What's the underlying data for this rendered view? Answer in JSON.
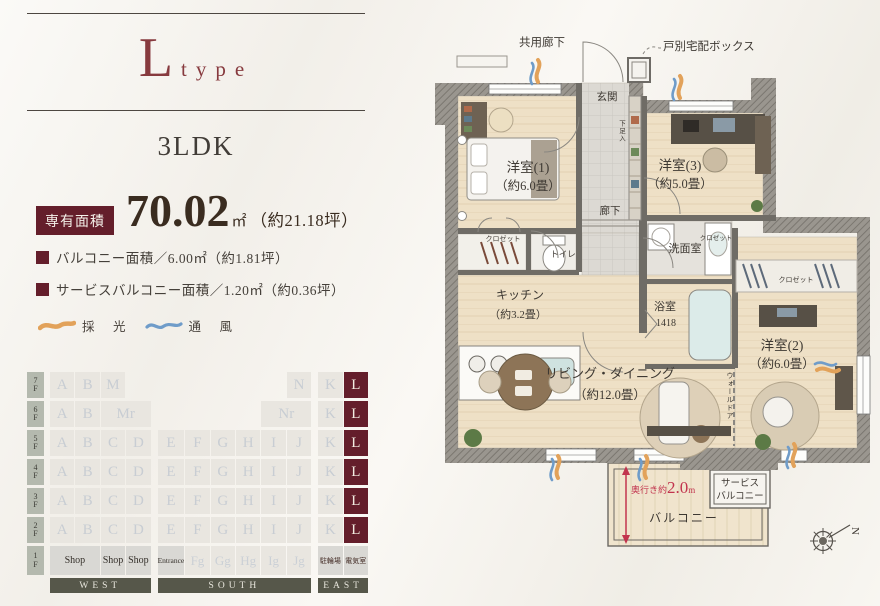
{
  "header": {
    "type_letter": "L",
    "type_word": "type",
    "plan_type": "3LDK"
  },
  "area": {
    "badge_label": "専有面積",
    "value": "70.02",
    "unit": "㎡",
    "tsubo_note": "（約21.18坪）",
    "sub_items": [
      "バルコニー面積／6.00㎡（約1.81坪）",
      "サービスバルコニー面積／1.20㎡（約0.36坪）"
    ]
  },
  "legend": {
    "daylight_label": "採　光",
    "ventilation_label": "通　風"
  },
  "colors": {
    "accent": "#641e2b",
    "plan_red": "#c2344e",
    "daylight": "#e2a25a",
    "ventilation": "#6f9cc9"
  },
  "floor_grid": {
    "highlight_unit": "L",
    "rows": [
      {
        "floor": "7F",
        "cells": [
          {
            "l": "A",
            "c": 1
          },
          {
            "l": "B",
            "c": 2
          },
          {
            "l": "M",
            "c": 3
          },
          {
            "l": "N",
            "c": 10
          },
          {
            "l": "K",
            "c": 11
          },
          {
            "l": "L",
            "c": 12,
            "t": "hl"
          }
        ]
      },
      {
        "floor": "6F",
        "cells": [
          {
            "l": "A",
            "c": 1
          },
          {
            "l": "B",
            "c": 2
          },
          {
            "l": "Mr",
            "c": 3,
            "s": 2
          },
          {
            "l": "Nr",
            "c": 9,
            "s": 2
          },
          {
            "l": "K",
            "c": 11
          },
          {
            "l": "L",
            "c": 12,
            "t": "hl"
          }
        ]
      },
      {
        "floor": "5F",
        "cells": [
          {
            "l": "A",
            "c": 1
          },
          {
            "l": "B",
            "c": 2
          },
          {
            "l": "C",
            "c": 3
          },
          {
            "l": "D",
            "c": 4
          },
          {
            "l": "E",
            "c": 5
          },
          {
            "l": "F",
            "c": 6
          },
          {
            "l": "G",
            "c": 7
          },
          {
            "l": "H",
            "c": 8
          },
          {
            "l": "I",
            "c": 9
          },
          {
            "l": "J",
            "c": 10
          },
          {
            "l": "K",
            "c": 11
          },
          {
            "l": "L",
            "c": 12,
            "t": "hl"
          }
        ]
      },
      {
        "floor": "4F",
        "cells": [
          {
            "l": "A",
            "c": 1
          },
          {
            "l": "B",
            "c": 2
          },
          {
            "l": "C",
            "c": 3
          },
          {
            "l": "D",
            "c": 4
          },
          {
            "l": "E",
            "c": 5
          },
          {
            "l": "F",
            "c": 6
          },
          {
            "l": "G",
            "c": 7
          },
          {
            "l": "H",
            "c": 8
          },
          {
            "l": "I",
            "c": 9
          },
          {
            "l": "J",
            "c": 10
          },
          {
            "l": "K",
            "c": 11
          },
          {
            "l": "L",
            "c": 12,
            "t": "hl"
          }
        ]
      },
      {
        "floor": "3F",
        "cells": [
          {
            "l": "A",
            "c": 1
          },
          {
            "l": "B",
            "c": 2
          },
          {
            "l": "C",
            "c": 3
          },
          {
            "l": "D",
            "c": 4
          },
          {
            "l": "E",
            "c": 5
          },
          {
            "l": "F",
            "c": 6
          },
          {
            "l": "G",
            "c": 7
          },
          {
            "l": "H",
            "c": 8
          },
          {
            "l": "I",
            "c": 9
          },
          {
            "l": "J",
            "c": 10
          },
          {
            "l": "K",
            "c": 11
          },
          {
            "l": "L",
            "c": 12,
            "t": "hl"
          }
        ]
      },
      {
        "floor": "2F",
        "cells": [
          {
            "l": "A",
            "c": 1
          },
          {
            "l": "B",
            "c": 2
          },
          {
            "l": "C",
            "c": 3
          },
          {
            "l": "D",
            "c": 4
          },
          {
            "l": "E",
            "c": 5
          },
          {
            "l": "F",
            "c": 6
          },
          {
            "l": "G",
            "c": 7
          },
          {
            "l": "H",
            "c": 8
          },
          {
            "l": "I",
            "c": 9
          },
          {
            "l": "J",
            "c": 10
          },
          {
            "l": "K",
            "c": 11
          },
          {
            "l": "L",
            "c": 12,
            "t": "hl"
          }
        ]
      },
      {
        "floor": "1F",
        "cells": [
          {
            "l": "Shop",
            "c": 1,
            "s": 2,
            "t": "shop"
          },
          {
            "l": "Shop",
            "c": 3,
            "t": "shop"
          },
          {
            "l": "Shop",
            "c": 4,
            "t": "shop"
          },
          {
            "l": "Entrance",
            "c": 5,
            "t": "shop sm"
          },
          {
            "l": "Fg",
            "c": 6,
            "t": "ghost"
          },
          {
            "l": "Gg",
            "c": 7,
            "t": "ghost"
          },
          {
            "l": "Hg",
            "c": 8,
            "t": "ghost"
          },
          {
            "l": "Ig",
            "c": 9,
            "t": "ghost"
          },
          {
            "l": "Jg",
            "c": 10,
            "t": "ghost"
          },
          {
            "l": "駐輪場",
            "c": 11,
            "t": "svc"
          },
          {
            "l": "電気室",
            "c": 12,
            "t": "svc"
          }
        ]
      }
    ],
    "directions": [
      {
        "label": "WEST",
        "col": 1,
        "span": 4
      },
      {
        "label": "SOUTH",
        "col": 5,
        "span": 6
      },
      {
        "label": "EAST",
        "col": 11,
        "span": 2
      }
    ]
  },
  "floorplan": {
    "common_corridor": "共用廊下",
    "delivery_box": "戸別宅配ボックス",
    "entrance": "玄関",
    "shoe_box": "下足入",
    "hallway": "廊下",
    "room1": "洋室(1)",
    "room1_size": "（約6.0畳）",
    "room3": "洋室(3)",
    "room3_size": "（約5.0畳）",
    "closet": "クロゼット",
    "toilet": "トイレ",
    "washroom": "洗面室",
    "kitchen": "キッチン",
    "kitchen_size": "（約3.2畳）",
    "bath": "浴室",
    "bath_size": "1418",
    "living": "リビング・ダイニング",
    "living_size": "（約12.0畳）",
    "room2": "洋室(2)",
    "room2_size": "（約6.0畳）",
    "wall_door": "ウォールドア",
    "depth_prefix": "奥行き約",
    "depth_value": "2.0",
    "depth_unit": "m",
    "balcony": "バルコニー",
    "service_balcony_1": "サービス",
    "service_balcony_2": "バルコニー",
    "compass_north": "N"
  }
}
